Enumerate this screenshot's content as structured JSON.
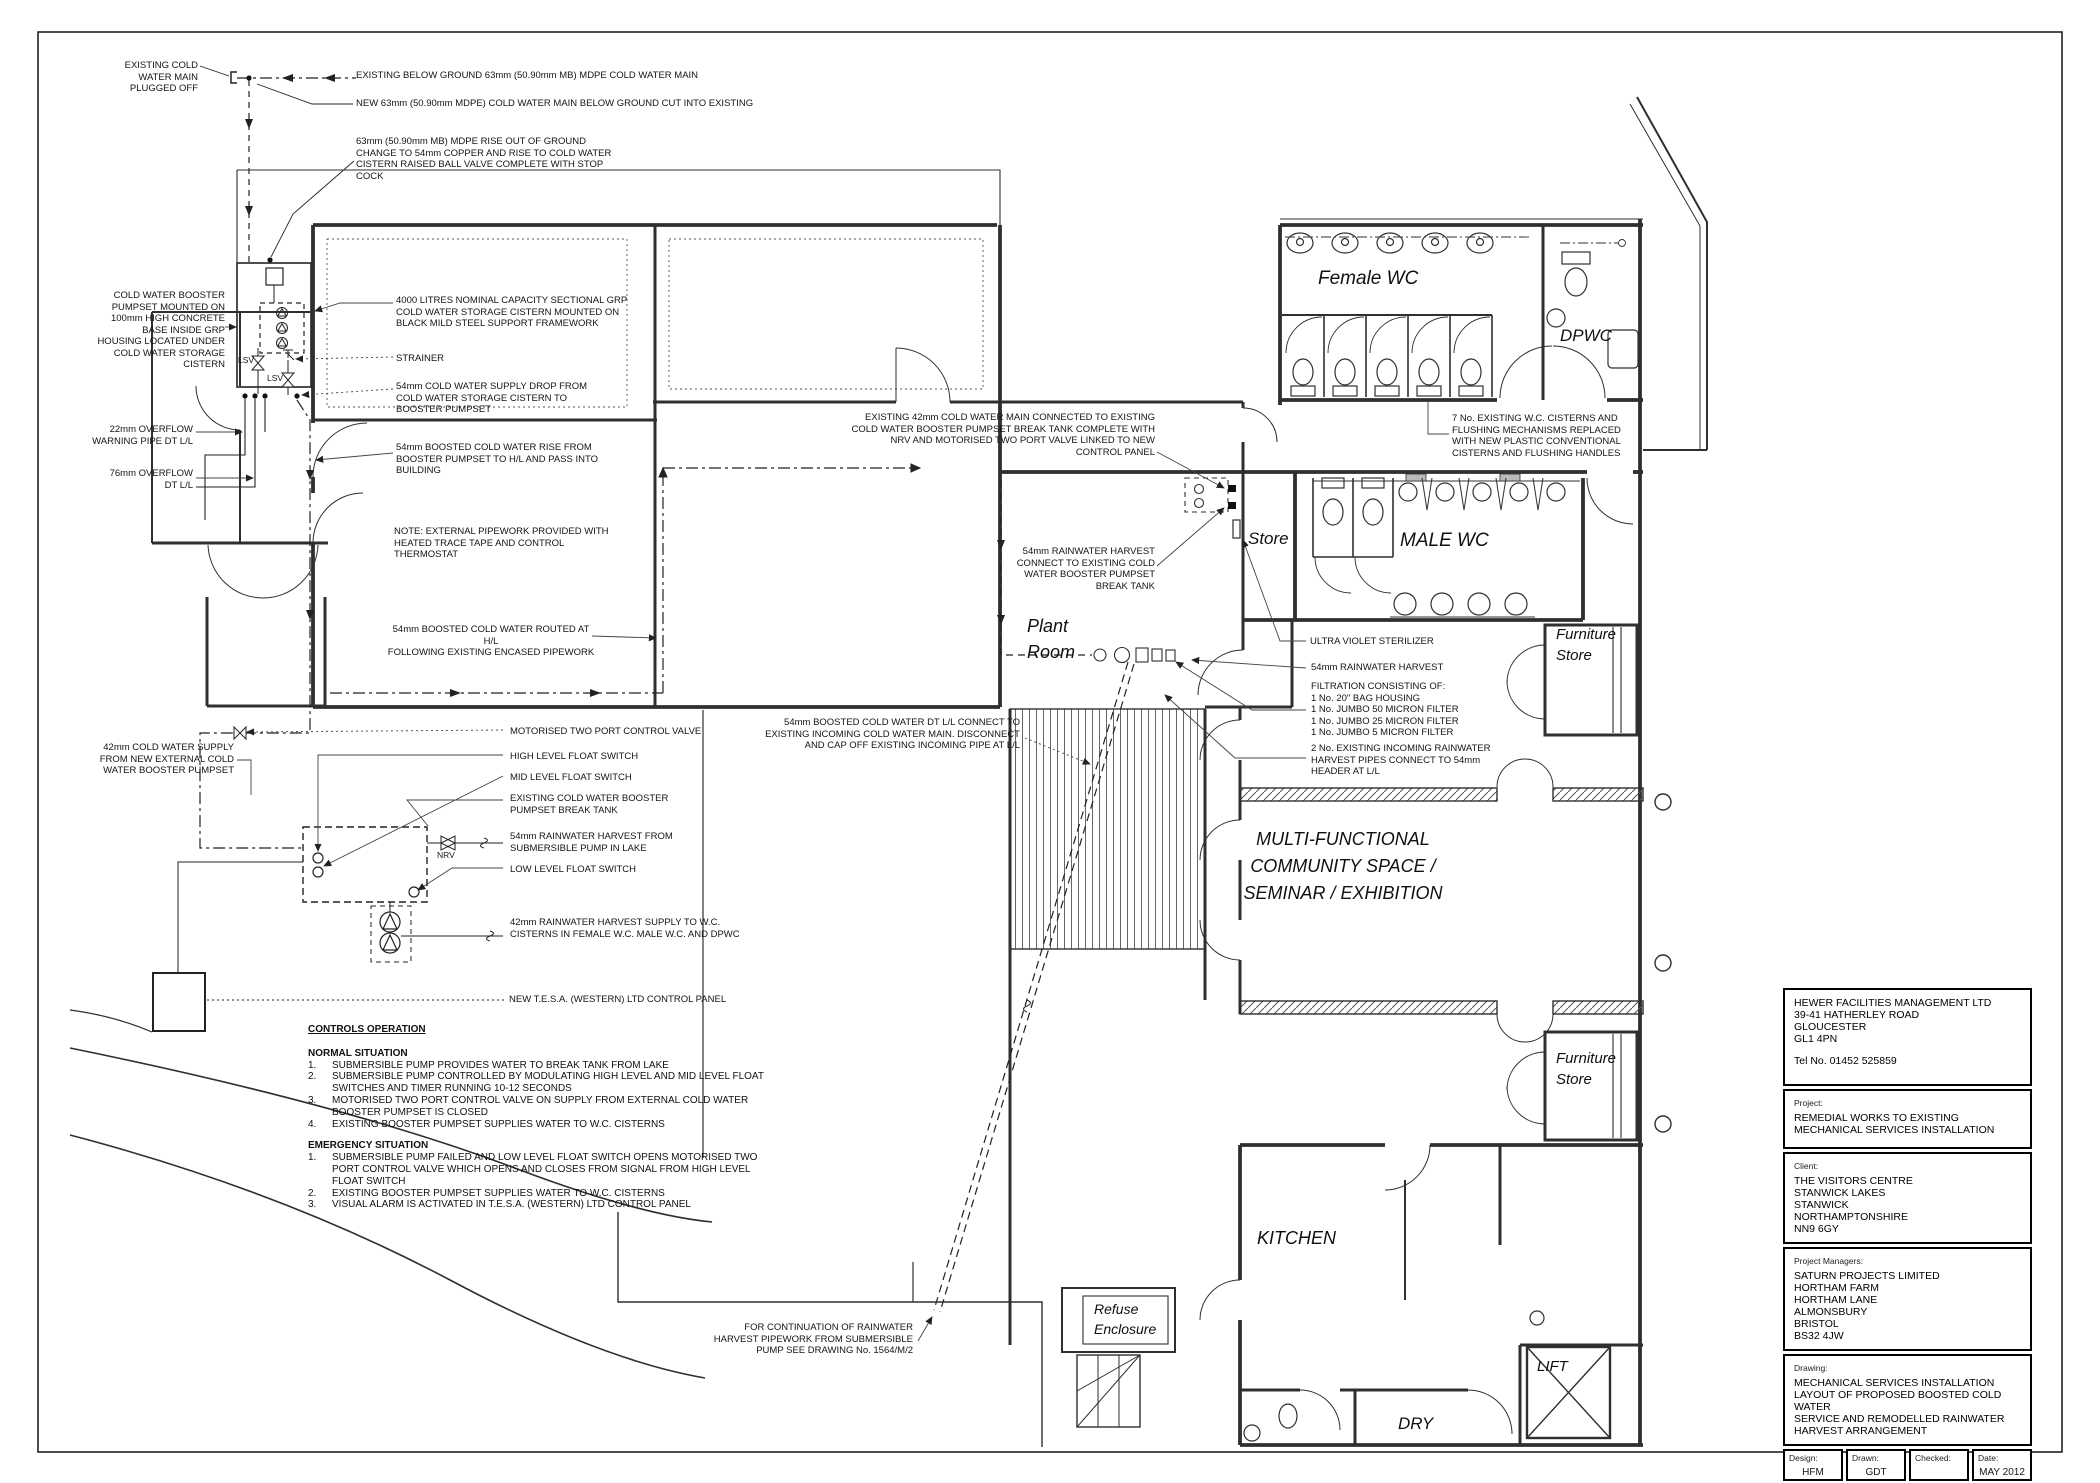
{
  "drawing": {
    "annotations": {
      "plugged_off": "EXISTING COLD\nWATER MAIN\nPLUGGED OFF",
      "existing_below_ground": "EXISTING BELOW GROUND 63mm (50.90mm MB) MDPE COLD WATER MAIN",
      "new_main": "NEW 63mm (50.90mm MDPE) COLD WATER MAIN BELOW GROUND CUT INTO EXISTING",
      "rise_out_of_ground": "63mm (50.90mm MB) MDPE RISE OUT OF GROUND\nCHANGE TO 54mm COPPER AND RISE TO COLD WATER\nCISTERN RAISED BALL VALVE COMPLETE WITH STOP\nCOCK",
      "booster_pumpset": "COLD WATER BOOSTER\nPUMPSET MOUNTED ON\n100mm HIGH CONCRETE\nBASE INSIDE GRP\nHOUSING LOCATED UNDER\nCOLD WATER STORAGE\nCISTERN",
      "cistern_4000": "4000 LITRES NOMINAL CAPACITY SECTIONAL GRP\nCOLD WATER STORAGE CISTERN MOUNTED ON\nBLACK MILD STEEL SUPPORT FRAMEWORK",
      "strainer": "STRAINER",
      "supply_drop": "54mm COLD WATER SUPPLY DROP FROM\nCOLD WATER STORAGE CISTERN TO\nBOOSTER PUMPSET",
      "overflow_22": "22mm OVERFLOW\nWARNING PIPE DT L/L",
      "overflow_76": "76mm OVERFLOW\nDT L/L",
      "boosted_rise": "54mm BOOSTED COLD WATER RISE FROM\nBOOSTER PUMPSET TO H/L AND PASS INTO\nBUILDING",
      "note_external": "NOTE: EXTERNAL PIPEWORK PROVIDED WITH\nHEATED TRACE TAPE AND CONTROL\nTHERMOSTAT",
      "routed_hl": "54mm BOOSTED COLD WATER ROUTED AT H/L\nFOLLOWING EXISTING ENCASED PIPEWORK",
      "existing_42": "EXISTING 42mm COLD WATER MAIN CONNECTED TO EXISTING\nCOLD WATER BOOSTER PUMPSET BREAK TANK COMPLETE WITH\nNRV AND MOTORISED TWO PORT VALVE LINKED TO NEW\nCONTROL PANEL",
      "rainwater_connect": "54mm RAINWATER HARVEST\nCONNECT TO EXISTING COLD\nWATER BOOSTER PUMPSET\nBREAK TANK",
      "cisterns_replaced": "7 No. EXISTING W.C. CISTERNS AND\nFLUSHING MECHANISMS REPLACED\nWITH NEW PLASTIC CONVENTIONAL\nCISTERNS AND FLUSHING HANDLES",
      "uv_sterilizer": "ULTRA VIOLET STERILIZER",
      "rainwater_54": "54mm RAINWATER HARVEST",
      "filtration": "FILTRATION CONSISTING OF:\n1 No. 20\" BAG HOUSING\n1 No. JUMBO 50 MICRON FILTER\n1 No. JUMBO 25 MICRON FILTER\n1 No. JUMBO 5 MICRON FILTER",
      "incoming_rainwater": "2 No. EXISTING INCOMING RAINWATER\nHARVEST PIPES CONNECT TO 54mm\nHEADER AT L/L",
      "cw_supply_42": "42mm COLD WATER SUPPLY\nFROM NEW EXTERNAL COLD\nWATER BOOSTER PUMPSET",
      "motorised_valve": "MOTORISED TWO PORT CONTROL VALVE",
      "high_float": "HIGH LEVEL FLOAT SWITCH",
      "mid_float": "MID LEVEL FLOAT SWITCH",
      "existing_break_tank": "EXISTING COLD WATER BOOSTER\nPUMPSET BREAK TANK",
      "rainwater_lake": "54mm RAINWATER HARVEST FROM\nSUBMERSIBLE PUMP IN LAKE",
      "low_float": "LOW LEVEL FLOAT SWITCH",
      "rainwater_supply_42": "42mm RAINWATER HARVEST SUPPLY TO W.C.\nCISTERNS IN FEMALE W.C. MALE W.C. AND DPWC",
      "control_panel": "NEW T.E.S.A. (WESTERN) LTD CONTROL PANEL",
      "boosted_dt_ll": "54mm BOOSTED COLD WATER DT L/L CONNECT TO\nEXISTING INCOMING COLD WATER MAIN. DISCONNECT\nAND CAP OFF EXISTING INCOMING PIPE AT L/L",
      "continuation": "FOR CONTINUATION OF RAINWATER\nHARVEST PIPEWORK FROM SUBMERSIBLE\nPUMP SEE DRAWING No. 1564/M/2",
      "lsv": "LSV",
      "nrv": "NRV"
    },
    "rooms": {
      "female_wc": "Female WC",
      "dpwc": "DPWC",
      "male_wc": "MALE WC",
      "store": "Store",
      "plant_room": "Plant\nRoom",
      "furniture_store": "Furniture\nStore",
      "multi_functional": "MULTI-FUNCTIONAL\nCOMMUNITY SPACE /\nSEMINAR / EXHIBITION",
      "kitchen": "KITCHEN",
      "refuse": "Refuse\nEnclosure",
      "dry": "DRY",
      "lift": "LIFT"
    },
    "controls": {
      "heading": "CONTROLS OPERATION",
      "normal_heading": "NORMAL SITUATION",
      "normal_items": [
        {
          "n": "1.",
          "t": "SUBMERSIBLE PUMP PROVIDES WATER TO BREAK TANK FROM LAKE"
        },
        {
          "n": "2.",
          "t": "SUBMERSIBLE PUMP CONTROLLED BY MODULATING HIGH LEVEL AND MID LEVEL FLOAT SWITCHES AND TIMER RUNNING 10-12 SECONDS"
        },
        {
          "n": "3.",
          "t": "MOTORISED TWO PORT CONTROL VALVE ON SUPPLY FROM EXTERNAL COLD WATER BOOSTER PUMPSET IS CLOSED"
        },
        {
          "n": "4.",
          "t": "EXISTING BOOSTER PUMPSET SUPPLIES WATER TO W.C. CISTERNS"
        }
      ],
      "emergency_heading": "EMERGENCY SITUATION",
      "emergency_items": [
        {
          "n": "1.",
          "t": "SUBMERSIBLE PUMP FAILED AND LOW LEVEL FLOAT SWITCH OPENS MOTORISED TWO PORT CONTROL VALVE WHICH OPENS AND CLOSES FROM SIGNAL FROM HIGH LEVEL FLOAT SWITCH"
        },
        {
          "n": "2.",
          "t": "EXISTING BOOSTER PUMPSET SUPPLIES WATER TO W.C. CISTERNS"
        },
        {
          "n": "3.",
          "t": "VISUAL ALARM IS ACTIVATED IN T.E.S.A. (WESTERN) LTD CONTROL PANEL"
        }
      ]
    },
    "title_block": {
      "company": "HEWER FACILITIES MANAGEMENT LTD\n39-41 HATHERLEY ROAD\nGLOUCESTER\nGL1 4PN",
      "tel": "Tel No. 01452 525859",
      "project_label": "Project:",
      "project": "REMEDIAL WORKS TO EXISTING\nMECHANICAL SERVICES INSTALLATION",
      "client_label": "Client:",
      "client": "THE VISITORS CENTRE\nSTANWICK LAKES\nSTANWICK\nNORTHAMPTONSHIRE\nNN9 6GY",
      "pm_label": "Project Managers:",
      "pm": "SATURN PROJECTS LIMITED\nHORTHAM FARM\nHORTHAM LANE\nALMONSBURY\nBRISTOL\nBS32 4JW",
      "drawing_label": "Drawing:",
      "drawing_title": "MECHANICAL SERVICES INSTALLATION\nLAYOUT OF PROPOSED BOOSTED COLD WATER\nSERVICE AND REMODELLED RAINWATER\nHARVEST ARRANGEMENT",
      "design_label": "Design:",
      "design": "HFM",
      "drawn_label": "Drawn:",
      "drawn": "GDT",
      "checked_label": "Checked:",
      "checked": "",
      "date_label": "Date:",
      "date": "MAY 2012",
      "drawing_no_label": "Drawing No:",
      "drawing_no": "1564/M/1",
      "scale_label": "Scale:",
      "scale": "1:50@A1"
    }
  }
}
